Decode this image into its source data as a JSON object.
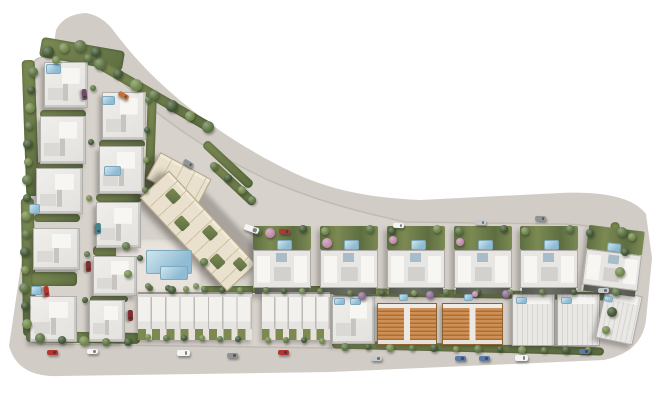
{
  "meta": {
    "title": "Aerial masterplan render of a residential villa compound",
    "canvas": {
      "w": 660,
      "h": 410
    }
  },
  "palette": {
    "background": "#ffffff",
    "road": "#d2ccc6",
    "parcel": "#d8d2cc",
    "plaza": "#e8e3dc",
    "grass1": "#7c8a52",
    "grass2": "#5d6e41",
    "poolA": "#cfe6ee",
    "poolB": "#8fbcd4",
    "block": "#e9e1cd",
    "orange_roof": "#c9894d",
    "roof_white": "#ecebe7"
  },
  "site": {
    "outer_path": "M 86 13 Q 104 16 116 34 C 160 92 225 140 292 172 C 330 190 370 198 420 200 L 560 193 Q 628 190 646 214 L 652 258 L 646 320 Q 642 352 604 360 L 330 372 L 60 376 Q 18 378 9 346 L 56 30 Q 64 14 86 13 Z",
    "inner_path": "M 96 54 C 140 106 200 148 268 180 C 310 198 350 210 405 222 L 560 224 Q 612 224 620 248 L 616 300 Q 612 336 578 344 L 330 348 L 40 344 Q 24 343 25 324 L 33 64 Q 34 52 96 54 Z"
  },
  "tree_tones": [
    "#3f5531",
    "#5a7240",
    "#6f8749",
    "#c08bab",
    "#8e6b94"
  ],
  "car_colors": {
    "red": "#b13832",
    "orange": "#c4703c",
    "white": "#f4f4f2",
    "silver": "#c6c9cc",
    "grey": "#8f9499",
    "blue": "#5b79a3",
    "teal": "#48838b",
    "dark": "#3a3e42",
    "purple": "#6e4a66",
    "darkred": "#7e2f2c"
  },
  "greens": [
    [
      40,
      44,
      84,
      20,
      10
    ],
    [
      24,
      60,
      13,
      136,
      -2
    ],
    [
      22,
      198,
      13,
      138,
      -1
    ],
    [
      92,
      91,
      126,
      10,
      30
    ],
    [
      206,
      180,
      56,
      9,
      43
    ],
    [
      196,
      160,
      64,
      9,
      43
    ],
    [
      26,
      332,
      114,
      11,
      1
    ],
    [
      138,
      286,
      194,
      7,
      0
    ],
    [
      332,
      290,
      276,
      8,
      1
    ],
    [
      332,
      344,
      272,
      8,
      1.5
    ],
    [
      614,
      222,
      9,
      64,
      -7
    ],
    [
      608,
      288,
      9,
      50,
      -16
    ],
    [
      40,
      110,
      46,
      8,
      0
    ],
    [
      37,
      162,
      46,
      8,
      0
    ],
    [
      34,
      214,
      46,
      8,
      0
    ],
    [
      31,
      272,
      46,
      14,
      0
    ],
    [
      99,
      140,
      46,
      8,
      0
    ],
    [
      96,
      194,
      46,
      8,
      0
    ],
    [
      93,
      246,
      44,
      10,
      0
    ],
    [
      90,
      296,
      38,
      6,
      0
    ],
    [
      146,
      92,
      9,
      112,
      2
    ]
  ],
  "shadows": [
    [
      148,
      206,
      126,
      34,
      47
    ]
  ],
  "buildings": {
    "villas": [
      [
        44,
        62,
        44,
        46,
        0
      ],
      [
        40,
        116,
        46,
        48,
        0
      ],
      [
        36,
        168,
        47,
        46,
        0
      ],
      [
        33,
        228,
        47,
        42,
        0
      ],
      [
        30,
        296,
        47,
        46,
        0
      ],
      [
        102,
        92,
        44,
        48,
        0
      ],
      [
        99,
        146,
        45,
        48,
        0
      ],
      [
        96,
        202,
        45,
        46,
        0
      ],
      [
        93,
        256,
        44,
        40,
        0
      ],
      [
        89,
        300,
        36,
        42,
        0
      ],
      [
        332,
        296,
        43,
        48,
        0
      ]
    ],
    "striped_houses": [
      [
        512,
        294,
        43,
        52,
        0
      ],
      [
        557,
        294,
        43,
        52,
        0
      ],
      [
        600,
        292,
        38,
        50,
        12
      ]
    ],
    "twins": [
      [
        253,
        226,
        58,
        68,
        0
      ],
      [
        320,
        226,
        58,
        68,
        0
      ],
      [
        387,
        226,
        58,
        68,
        0
      ],
      [
        454,
        226,
        58,
        68,
        0
      ],
      [
        520,
        226,
        58,
        68,
        0
      ],
      [
        585,
        228,
        56,
        66,
        7
      ]
    ],
    "rowhouses": [
      {
        "x": 138,
        "y": 292,
        "w": 114,
        "h": 48,
        "units": 8
      },
      {
        "x": 262,
        "y": 292,
        "w": 68,
        "h": 48,
        "units": 5
      }
    ],
    "orange_houses": [
      [
        377,
        303,
        60,
        42,
        0
      ],
      [
        442,
        303,
        61,
        42,
        0
      ]
    ],
    "block": {
      "main": [
        134,
        211,
        128,
        40,
        47
      ],
      "annex": [
        150,
        164,
        58,
        30,
        28
      ],
      "roof_gardens": [
        [
          14,
          8,
          13,
          11
        ],
        [
          40,
          20,
          13,
          11
        ],
        [
          66,
          6,
          13,
          11
        ],
        [
          92,
          20,
          13,
          11
        ],
        [
          110,
          6,
          12,
          10
        ]
      ]
    },
    "plaza": [
      116,
      238,
      86,
      56,
      0
    ]
  },
  "pools": [
    [
      146,
      250,
      46,
      24,
      0
    ],
    [
      160,
      266,
      28,
      14,
      0
    ],
    [
      46,
      64,
      15,
      10,
      0
    ],
    [
      102,
      96,
      13,
      9,
      0
    ],
    [
      104,
      166,
      17,
      10,
      0
    ],
    [
      29,
      204,
      11,
      10,
      0
    ],
    [
      31,
      286,
      11,
      9,
      0
    ],
    [
      277,
      240,
      15,
      10,
      0
    ],
    [
      344,
      240,
      15,
      10,
      0
    ],
    [
      411,
      240,
      15,
      10,
      0
    ],
    [
      478,
      240,
      15,
      10,
      0
    ],
    [
      544,
      240,
      15,
      10,
      0
    ],
    [
      607,
      243,
      14,
      9,
      7
    ],
    [
      334,
      298,
      11,
      7,
      0
    ],
    [
      350,
      298,
      11,
      7,
      0
    ],
    [
      399,
      294,
      9,
      7,
      0
    ],
    [
      464,
      294,
      9,
      7,
      0
    ],
    [
      516,
      297,
      11,
      7,
      0
    ],
    [
      561,
      297,
      11,
      7,
      0
    ],
    [
      604,
      296,
      9,
      6,
      12
    ]
  ],
  "trees": [
    [
      100,
      64,
      6,
      1
    ],
    [
      118,
      74,
      5,
      0
    ],
    [
      136,
      85,
      6,
      2
    ],
    [
      154,
      95,
      5,
      1
    ],
    [
      172,
      106,
      6,
      0
    ],
    [
      190,
      116,
      5,
      2
    ],
    [
      208,
      127,
      6,
      1
    ],
    [
      214,
      166,
      4,
      1
    ],
    [
      228,
      178,
      4,
      0
    ],
    [
      242,
      190,
      4,
      2
    ],
    [
      252,
      200,
      4,
      1
    ],
    [
      48,
      52,
      6,
      0
    ],
    [
      64,
      48,
      5,
      2
    ],
    [
      80,
      46,
      6,
      1
    ],
    [
      96,
      52,
      5,
      0
    ],
    [
      56,
      60,
      4,
      2
    ],
    [
      88,
      58,
      4,
      1
    ],
    [
      33,
      72,
      5,
      1
    ],
    [
      31,
      90,
      4,
      0
    ],
    [
      30,
      108,
      5,
      2
    ],
    [
      29,
      126,
      4,
      1
    ],
    [
      28,
      144,
      5,
      0
    ],
    [
      28,
      162,
      4,
      2
    ],
    [
      27,
      180,
      5,
      1
    ],
    [
      27,
      198,
      4,
      0
    ],
    [
      26,
      216,
      5,
      2
    ],
    [
      26,
      234,
      4,
      1
    ],
    [
      25,
      252,
      5,
      0
    ],
    [
      25,
      270,
      4,
      2
    ],
    [
      24,
      288,
      5,
      1
    ],
    [
      25,
      306,
      4,
      0
    ],
    [
      27,
      324,
      5,
      2
    ],
    [
      40,
      338,
      5,
      1
    ],
    [
      62,
      340,
      4,
      0
    ],
    [
      84,
      341,
      5,
      2
    ],
    [
      106,
      342,
      4,
      1
    ],
    [
      128,
      342,
      4,
      0
    ],
    [
      148,
      337,
      3,
      2
    ],
    [
      166,
      338,
      3,
      1
    ],
    [
      184,
      338,
      3,
      0
    ],
    [
      202,
      338,
      3,
      2
    ],
    [
      220,
      339,
      3,
      1
    ],
    [
      238,
      339,
      3,
      0
    ],
    [
      268,
      340,
      3,
      2
    ],
    [
      286,
      340,
      3,
      1
    ],
    [
      304,
      340,
      3,
      0
    ],
    [
      322,
      341,
      3,
      2
    ],
    [
      150,
      288,
      3,
      1
    ],
    [
      168,
      288,
      3,
      0
    ],
    [
      186,
      289,
      3,
      2
    ],
    [
      204,
      289,
      3,
      1
    ],
    [
      222,
      290,
      3,
      0
    ],
    [
      240,
      290,
      3,
      2
    ],
    [
      266,
      290,
      3,
      1
    ],
    [
      284,
      291,
      3,
      0
    ],
    [
      302,
      291,
      3,
      2
    ],
    [
      320,
      291,
      3,
      1
    ],
    [
      345,
      347,
      4,
      1
    ],
    [
      368,
      347,
      3,
      0
    ],
    [
      390,
      348,
      4,
      2
    ],
    [
      412,
      348,
      3,
      1
    ],
    [
      434,
      348,
      4,
      0
    ],
    [
      456,
      349,
      3,
      2
    ],
    [
      478,
      349,
      4,
      1
    ],
    [
      500,
      349,
      3,
      0
    ],
    [
      522,
      350,
      4,
      2
    ],
    [
      544,
      350,
      3,
      1
    ],
    [
      566,
      350,
      4,
      0
    ],
    [
      588,
      350,
      3,
      2
    ],
    [
      350,
      293,
      3,
      1
    ],
    [
      382,
      293,
      3,
      0
    ],
    [
      414,
      293,
      3,
      2
    ],
    [
      446,
      292,
      3,
      1
    ],
    [
      478,
      292,
      3,
      0
    ],
    [
      510,
      292,
      3,
      2
    ],
    [
      542,
      292,
      3,
      1
    ],
    [
      574,
      292,
      3,
      0
    ],
    [
      362,
      296,
      4,
      4
    ],
    [
      430,
      295,
      4,
      4
    ],
    [
      475,
      294,
      3,
      3
    ],
    [
      506,
      294,
      4,
      4
    ],
    [
      622,
      232,
      5,
      1
    ],
    [
      625,
      252,
      4,
      0
    ],
    [
      620,
      272,
      5,
      2
    ],
    [
      616,
      292,
      4,
      1
    ],
    [
      612,
      312,
      5,
      0
    ],
    [
      606,
      330,
      4,
      2
    ],
    [
      126,
      246,
      4,
      1
    ],
    [
      140,
      258,
      3,
      0
    ],
    [
      128,
      274,
      4,
      2
    ],
    [
      148,
      286,
      3,
      1
    ],
    [
      172,
      290,
      4,
      0
    ],
    [
      196,
      286,
      3,
      2
    ],
    [
      204,
      262,
      4,
      1
    ],
    [
      93,
      88,
      3,
      1
    ],
    [
      91,
      142,
      3,
      0
    ],
    [
      89,
      198,
      3,
      2
    ],
    [
      87,
      254,
      3,
      1
    ],
    [
      85,
      300,
      3,
      0
    ],
    [
      148,
      100,
      3,
      1
    ],
    [
      147,
      130,
      3,
      0
    ],
    [
      146,
      160,
      3,
      2
    ],
    [
      145,
      190,
      3,
      1
    ],
    [
      258,
      231,
      4,
      1
    ],
    [
      303,
      229,
      4,
      0
    ],
    [
      325,
      231,
      4,
      2
    ],
    [
      370,
      229,
      4,
      1
    ],
    [
      392,
      231,
      4,
      0
    ],
    [
      437,
      229,
      4,
      2
    ],
    [
      459,
      231,
      4,
      1
    ],
    [
      504,
      229,
      4,
      0
    ],
    [
      525,
      231,
      4,
      2
    ],
    [
      570,
      229,
      4,
      1
    ],
    [
      590,
      233,
      4,
      0
    ],
    [
      632,
      237,
      4,
      2
    ],
    [
      270,
      233,
      5,
      3
    ],
    [
      327,
      243,
      5,
      3
    ],
    [
      393,
      240,
      4,
      3
    ],
    [
      460,
      242,
      4,
      3
    ]
  ],
  "cars": [
    [
      123,
      95,
      30,
      "orange",
      "car"
    ],
    [
      188,
      163,
      32,
      "grey",
      "car"
    ],
    [
      251,
      229,
      20,
      "white",
      "truck"
    ],
    [
      284,
      231,
      4,
      "red",
      "car"
    ],
    [
      398,
      225,
      2,
      "white",
      "car"
    ],
    [
      480,
      222,
      2,
      "silver",
      "car"
    ],
    [
      540,
      218,
      2,
      "grey",
      "car"
    ],
    [
      603,
      290,
      0,
      "silver",
      "car"
    ],
    [
      52,
      352,
      0,
      "red",
      "car"
    ],
    [
      92,
      351,
      0,
      "white",
      "car"
    ],
    [
      183,
      353,
      0,
      "white",
      "van"
    ],
    [
      232,
      355,
      0,
      "grey",
      "car"
    ],
    [
      283,
      352,
      0,
      "red",
      "car"
    ],
    [
      376,
      358,
      0,
      "silver",
      "car"
    ],
    [
      460,
      358,
      0,
      "blue",
      "car"
    ],
    [
      484,
      358,
      0,
      "blue",
      "car"
    ],
    [
      521,
      358,
      0,
      "white",
      "van"
    ],
    [
      584,
      351,
      0,
      "blue",
      "car"
    ],
    [
      98,
      228,
      88,
      "teal",
      "car"
    ],
    [
      88,
      266,
      88,
      "darkred",
      "car"
    ],
    [
      46,
      291,
      82,
      "red",
      "car"
    ],
    [
      130,
      315,
      88,
      "darkred",
      "car"
    ],
    [
      84,
      94,
      84,
      "purple",
      "car"
    ]
  ]
}
